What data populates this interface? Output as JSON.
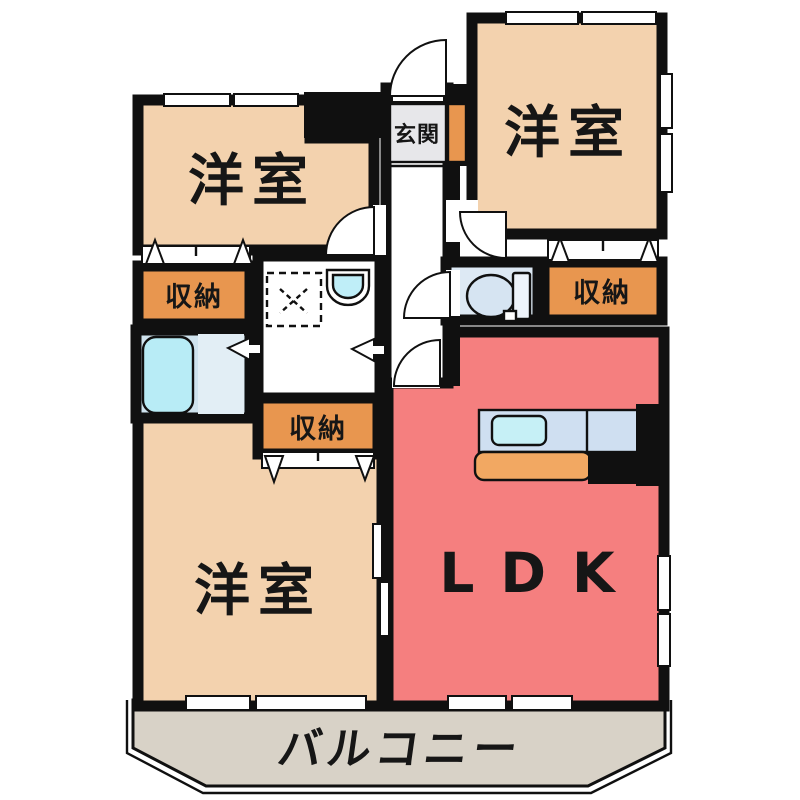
{
  "rooms": {
    "bedroom_nw": {
      "label": "洋室"
    },
    "bedroom_ne": {
      "label": "洋室"
    },
    "bedroom_sw": {
      "label": "洋室"
    },
    "ldk": {
      "label": "LDK"
    },
    "entrance": {
      "label": "玄関"
    },
    "storage_nw": {
      "label": "収納"
    },
    "storage_ne": {
      "label": "収納"
    },
    "storage_center": {
      "label": "収納"
    },
    "balcony": {
      "label": "バルコニー"
    }
  },
  "colors": {
    "wall": "#101010",
    "bedroom": "#f3d2ae",
    "storage": "#e8964f",
    "ldk": "#f57f7f",
    "balcony": "#d8d2c7",
    "entrance_floor": "#e7e7ea",
    "toilet_room": "#dde9f4",
    "bathroom_floor": "#cfe3ee",
    "bathroom_right_floor": "#e2eef5",
    "bathtub": "#b8ecf6",
    "kitchen_counter": "#cfdff1",
    "kitchen_sink": "#c6f0f6",
    "kitchen_counter_low": "#f2a862",
    "toilet_fixture": "#d6e4f2",
    "toilet_tank": "#eef4fb",
    "basin_bowl": "#bfeef8",
    "hall_floor": "#ffffff"
  }
}
